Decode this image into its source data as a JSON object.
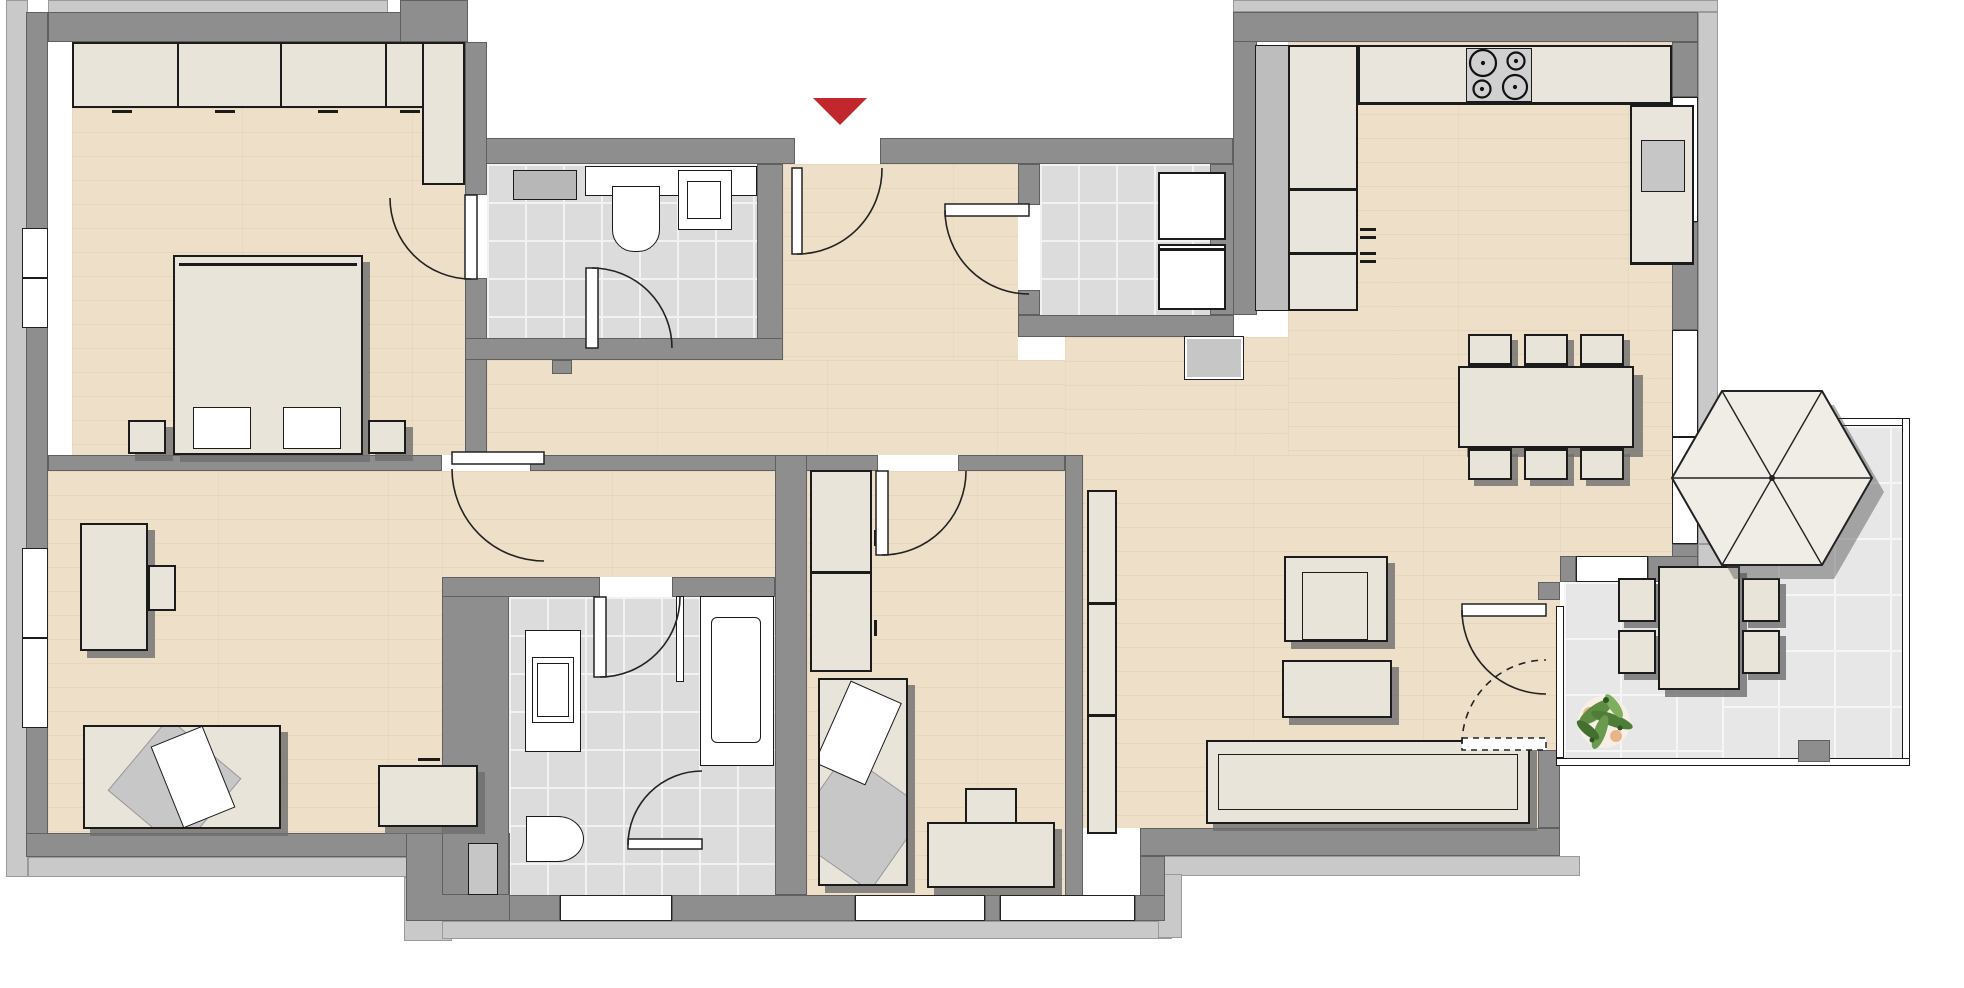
{
  "plan": {
    "kind": "apartment-floor-plan",
    "view": "top-down",
    "visible_text": [],
    "colors": {
      "wall": "#8e8e8e",
      "trim": "#c9c9c9",
      "wood_floor": "#eee0c8",
      "tile_floor": "#dcdcdc",
      "terrace_tile": "#e7e7e7",
      "furniture": "#e9e4da",
      "fixture_white": "#ffffff",
      "entrance_arrow_red": "#c1272d",
      "appliance_gray": "#c6c6c6",
      "plant_green": "#4e7d38"
    },
    "entrance": {
      "marker": "red-triangle-arrow",
      "direction": "down-into-hallway",
      "location": "top-center"
    },
    "rooms": [
      {
        "id": "bedroom-1",
        "position": "top-left",
        "floor": "wood",
        "furniture": [
          "wardrobe-4-sections",
          "corner-cabinet",
          "double-bed",
          "nightstand-left",
          "nightstand-right"
        ],
        "windows": [
          "left-wall"
        ]
      },
      {
        "id": "bedroom-2",
        "position": "bottom-left",
        "floor": "wood",
        "furniture": [
          "desk",
          "desk-chair",
          "single-bed-with-pillow",
          "dresser"
        ],
        "windows": [
          "left-wall"
        ]
      },
      {
        "id": "guest-wc",
        "position": "top-center",
        "floor": "tile",
        "furniture": [
          "radiator",
          "toilet",
          "washbasin"
        ]
      },
      {
        "id": "hallway",
        "position": "center",
        "floor": "wood",
        "furniture": []
      },
      {
        "id": "bathroom",
        "position": "bottom-center",
        "floor": "tile",
        "furniture": [
          "vanity-sink",
          "toilet",
          "bathtub",
          "shower-glass-partition"
        ],
        "windows": [
          "bottom-wall"
        ]
      },
      {
        "id": "bedroom-3",
        "position": "bottom-middle",
        "floor": "wood",
        "furniture": [
          "tall-wardrobe-2-sections",
          "single-bed-with-pillow",
          "desk",
          "desk-chair"
        ],
        "windows": [
          "bottom-wall"
        ]
      },
      {
        "id": "utility-room",
        "position": "top-center-right",
        "floor": "tile",
        "furniture": [
          "washer",
          "dryer",
          "service-niche"
        ]
      },
      {
        "id": "kitchen",
        "position": "top-right",
        "floor": "wood",
        "furniture": [
          "tall-cabinet-column",
          "counter-left-3-sections",
          "counter-top-run",
          "cooktop-4-burners",
          "counter-right",
          "countertop-appliance"
        ]
      },
      {
        "id": "dining-area",
        "position": "right",
        "floor": "wood",
        "furniture": [
          "dining-table",
          "chairs-top-x3",
          "chairs-bottom-x3"
        ],
        "windows": [
          "right-wall-upper",
          "right-wall-lower"
        ]
      },
      {
        "id": "living-area",
        "position": "center-right",
        "floor": "wood",
        "furniture": [
          "sideboard-3-sections",
          "armchair",
          "side-table",
          "sofa"
        ],
        "windows": [
          "bottom-wall",
          "terrace-side-wall"
        ]
      },
      {
        "id": "terrace",
        "position": "bottom-right",
        "floor": "terrace-tile",
        "outline": "thin-railing",
        "furniture": [
          "parasol-hexagonal",
          "outdoor-table",
          "outdoor-chairs-x4",
          "potted-plant",
          "corner-post"
        ]
      }
    ],
    "doors": [
      {
        "id": "entrance-door",
        "between": [
          "outside",
          "hallway"
        ],
        "swing": "arc"
      },
      {
        "id": "bedroom-1-door",
        "between": [
          "hallway",
          "bedroom-1"
        ],
        "swing": "arc"
      },
      {
        "id": "bedroom-2-door",
        "between": [
          "hallway",
          "bedroom-2-corridor"
        ],
        "swing": "arc"
      },
      {
        "id": "guest-wc-door",
        "between": [
          "hallway",
          "guest-wc"
        ],
        "swing": "arc"
      },
      {
        "id": "bathroom-door",
        "between": [
          "corridor",
          "bathroom"
        ],
        "swing": "arc"
      },
      {
        "id": "shower-door",
        "between": [
          "bathroom",
          "shower-area"
        ],
        "swing": "arc"
      },
      {
        "id": "bedroom-3-door",
        "between": [
          "hallway",
          "bedroom-3"
        ],
        "swing": "arc"
      },
      {
        "id": "utility-door",
        "between": [
          "hallway",
          "utility-room"
        ],
        "swing": "arc"
      },
      {
        "id": "terrace-door-leaf-1",
        "between": [
          "living-area",
          "terrace"
        ],
        "swing": "arc"
      },
      {
        "id": "terrace-door-leaf-2",
        "between": [
          "living-area",
          "terrace"
        ],
        "swing": "dashed-arc"
      }
    ]
  }
}
